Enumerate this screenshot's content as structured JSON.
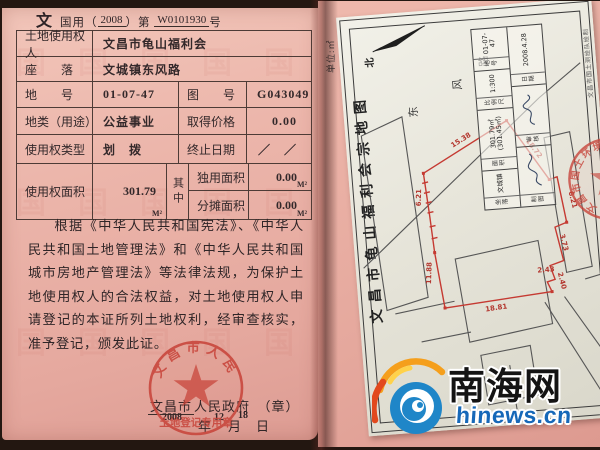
{
  "certificate": {
    "corner_char": "文",
    "serial": {
      "prefix": "国用（",
      "year": "2008",
      "mid": "）第",
      "number": "W0101930",
      "suffix": "号"
    },
    "table": {
      "rows": [
        {
          "label": "土地使用权人",
          "value": "文昌市龟山福利会"
        },
        {
          "label": "座　　落",
          "value": "文城镇东风路"
        },
        {
          "label": "地　　号",
          "value": "01-07-47",
          "label2": "图　　号",
          "value2": "G043049"
        },
        {
          "label": "地类（用途）",
          "value": "公益事业",
          "label2": "取得价格",
          "value2": "0.00"
        },
        {
          "label": "使用权类型",
          "value": "划　拨",
          "label2": "终止日期",
          "value2": "／　／"
        },
        {
          "label": "使用权面积",
          "value": "301.79",
          "unit": "M²",
          "qizhong": "其中",
          "sub1_label": "独用面积",
          "sub1_value": "0.00",
          "sub1_unit": "M²",
          "sub2_label": "分摊面积",
          "sub2_value": "0.00",
          "sub2_unit": "M²"
        }
      ]
    },
    "paragraph": "根据《中华人民共和国宪法》、《中华人民共和国土地管理法》和《中华人民共和国城市房地产管理法》等法律法规，为保护土地使用权人的合法权益，对土地使用权人申请登记的本证所列土地权利，经审查核实，准予登记，颁发此证。",
    "issuer": {
      "name": "文昌市",
      "org": "人民政府",
      "seal_mark": "（章）"
    },
    "date": {
      "year": "2008",
      "month": "12",
      "day": "18",
      "year_label": "年",
      "month_label": "月",
      "day_label": "日"
    },
    "seal": {
      "arc_text": "文昌市人民政府",
      "bottom_text": "土地登记专用章"
    },
    "pattern_char": "国"
  },
  "map": {
    "unit_note": "单位:㎡",
    "title": "文昌市龟山福利会宗地图",
    "north_label": "北",
    "road_chars": [
      "东",
      "风",
      "路"
    ],
    "dims": {
      "top1": "15.38",
      "top2": "18.72",
      "left1": "6.21",
      "left2": "11.88",
      "bottom": "18.81",
      "right1": "6.21",
      "right2": "3.73",
      "right3": "2.43",
      "right4": "2.40"
    },
    "info_table": {
      "row1": [
        {
          "label": "坐落",
          "value": "文城镇"
        },
        {
          "label": "面积",
          "value": "301.79㎡ (301.45㎡)"
        },
        {
          "label": "比例尺",
          "value": "1:300"
        },
        {
          "label": "地号",
          "value": "01-07-47"
        }
      ],
      "row2": [
        {
          "label": "制图",
          "value": ""
        },
        {
          "label": "审核",
          "value": ""
        },
        {
          "label": "日期",
          "value": "2008.4.28"
        }
      ]
    },
    "caption": "文昌市国土测绘队绘制",
    "seal_text": "文昌市国土环境资源局"
  },
  "watermark": {
    "cn": "南海网",
    "en": "hinews.cn"
  },
  "colors": {
    "gov_seal_red": "#c8453b",
    "parcel_red": "#c53a32",
    "wm_blue": "#1668b8",
    "swirl_orange": "#f59f1c",
    "swirl_red": "#e2491d",
    "swirl_blue": "#1f86c8"
  }
}
